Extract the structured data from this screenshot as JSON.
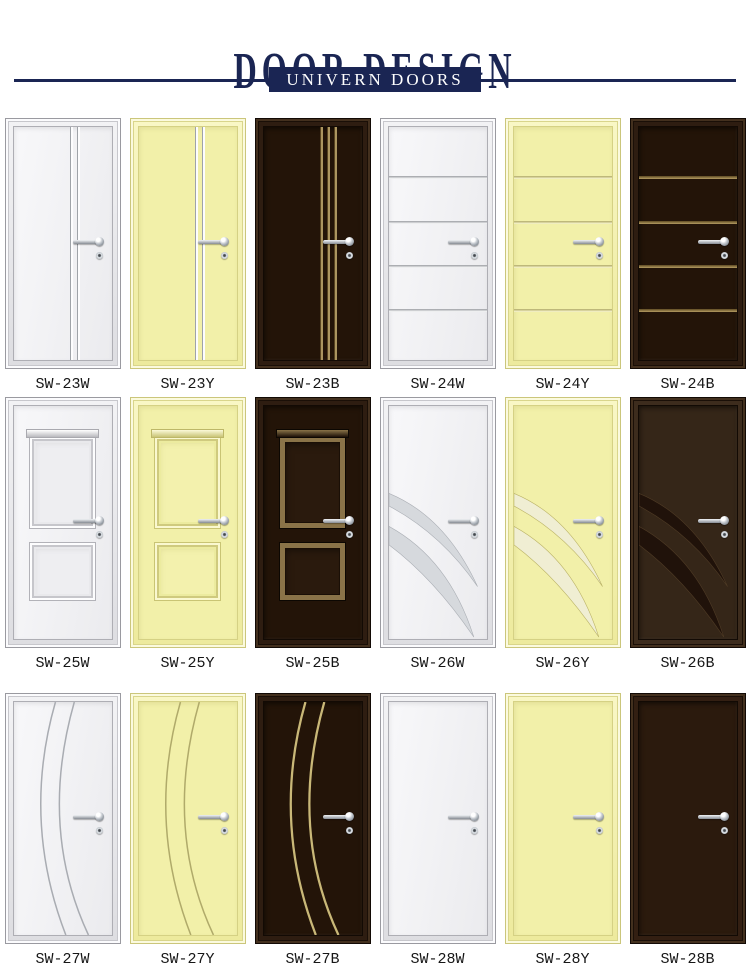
{
  "header": {
    "title": "DOOR DESIGN",
    "banner": "UNIVERN DOORS"
  },
  "colors": {
    "navy": "#1a2553",
    "door_white": "#f4f4f6",
    "door_yellow": "#f2f0a9",
    "door_dark": "#23150b",
    "inlay_gold": "#ab9560",
    "inlay_silver": "#c3c8ce"
  },
  "doors": [
    {
      "code": "SW-23W",
      "style": "sw23-w"
    },
    {
      "code": "SW-23Y",
      "style": "sw23-y"
    },
    {
      "code": "SW-23B",
      "style": "sw23-b"
    },
    {
      "code": "SW-24W",
      "style": "sw24-w"
    },
    {
      "code": "SW-24Y",
      "style": "sw24-y"
    },
    {
      "code": "SW-24B",
      "style": "sw24-b"
    },
    {
      "code": "SW-25W",
      "style": "sw25-w"
    },
    {
      "code": "SW-25Y",
      "style": "sw25-y"
    },
    {
      "code": "SW-25B",
      "style": "sw25-b"
    },
    {
      "code": "SW-26W",
      "style": "sw26-w"
    },
    {
      "code": "SW-26Y",
      "style": "sw26-y"
    },
    {
      "code": "SW-26B",
      "style": "sw26-b"
    },
    {
      "code": "SW-27W",
      "style": "sw27-w"
    },
    {
      "code": "SW-27Y",
      "style": "sw27-y"
    },
    {
      "code": "SW-27B",
      "style": "sw27-b"
    },
    {
      "code": "SW-28W",
      "style": "sw28-w"
    },
    {
      "code": "SW-28Y",
      "style": "sw28-y"
    },
    {
      "code": "SW-28B",
      "style": "sw28-b"
    }
  ]
}
